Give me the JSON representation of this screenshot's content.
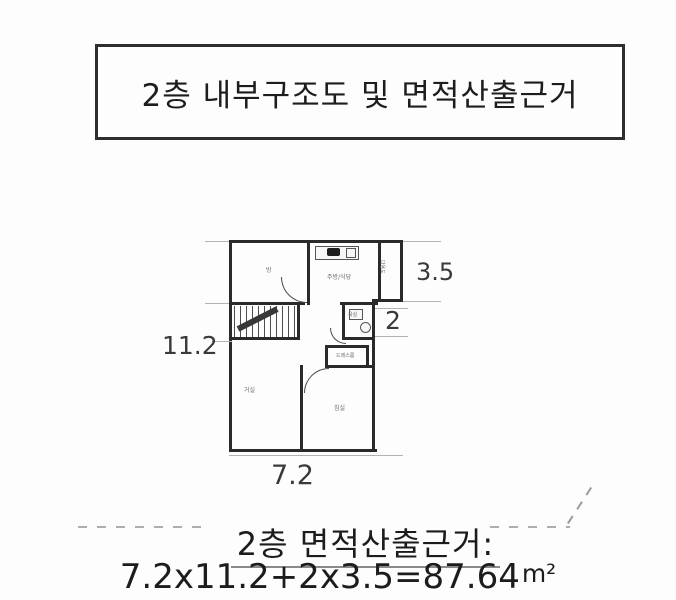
{
  "title": {
    "text": "2층 내부구조도 및 면적산출근거"
  },
  "plan": {
    "rooms": {
      "room": "방",
      "kitchen": "주방/식당",
      "utility": "다용도",
      "bath": "욕실",
      "closet": "드레스룸",
      "living": "거실",
      "bedroom": "침실"
    },
    "dimensions": {
      "right": "3.5",
      "left": "11.2",
      "bath": "2",
      "bottom": "7.2"
    }
  },
  "footer": {
    "heading": "2층 면적산출근거:",
    "formula": "7.2x11.2+2x3.5=87.64",
    "unit": "m²"
  },
  "colors": {
    "ink": "#1c1c1c",
    "wall": "#2a2a2a",
    "faint_line": "#b3b3b3"
  }
}
